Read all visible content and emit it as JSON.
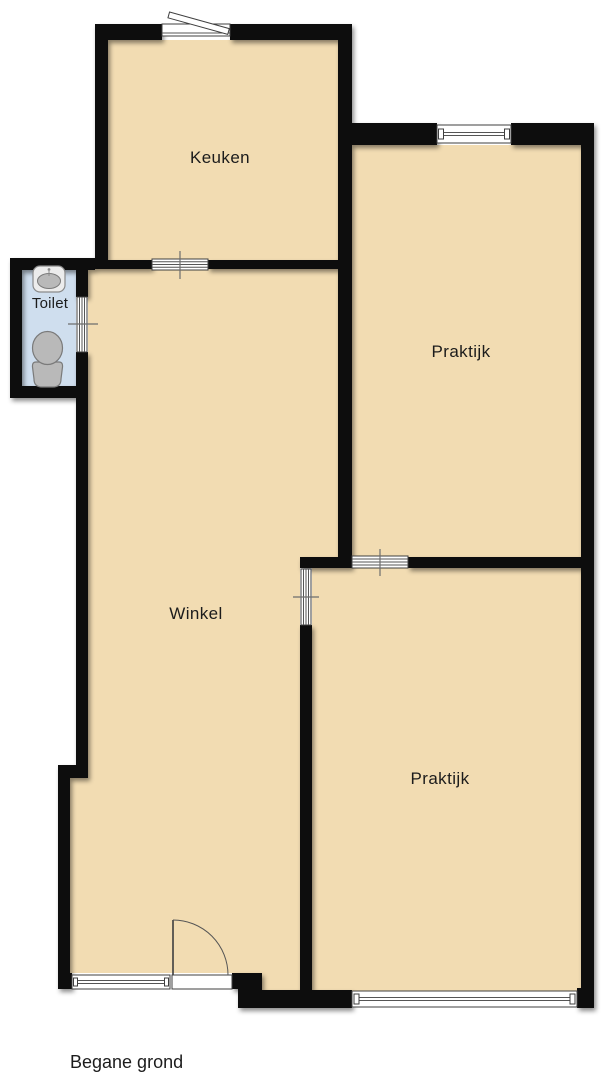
{
  "floorplan": {
    "title": "Begane grond",
    "rooms": {
      "keuken": {
        "label": "Keuken"
      },
      "toilet": {
        "label": "Toilet"
      },
      "praktijk_boven": {
        "label": "Praktijk"
      },
      "winkel": {
        "label": "Winkel"
      },
      "praktijk_onder": {
        "label": "Praktijk"
      }
    },
    "colors": {
      "background": "#ffffff",
      "floor": "#f2dcb2",
      "toilet_floor": "#cfdeee",
      "wall": "#0d0d0d",
      "fixture_fill": "#b9b9b9",
      "fixture_stroke": "#777777",
      "symbol_stroke": "#3f3f3f",
      "text": "#1c1c1c"
    }
  }
}
